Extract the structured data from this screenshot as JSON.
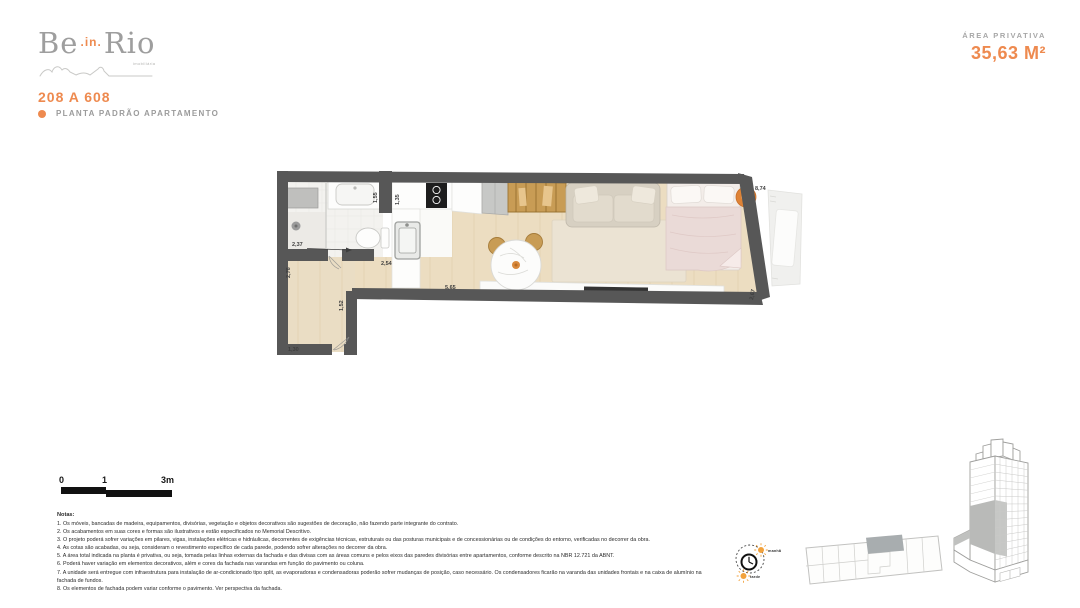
{
  "brand": {
    "be": "Be",
    "in": ".in.",
    "rio": "Rio",
    "tagline": "imobiliária"
  },
  "header": {
    "unit_range": "208 A 608",
    "plan_type": "PLANTA PADRÃO APARTAMENTO",
    "area_label": "ÁREA PRIVATIVA",
    "area_value": "35,63 M²"
  },
  "floorplan": {
    "dims": {
      "bath_width": "2,37",
      "left_side": "2,76",
      "hall": "2,54",
      "top_a": "1,55",
      "top_b": "1,35",
      "living_length": "5,65",
      "entry_side": "1,52",
      "entry_width": "1,30",
      "total_length": "8,74",
      "right_side": "2,67"
    }
  },
  "scale_bar": {
    "zero": "0",
    "one": "1",
    "three": "3m"
  },
  "notes": {
    "heading": "Notas:",
    "items": [
      "1. Os móveis, bancadas de madeira, equipamentos, divisórias, vegetação e objetos decorativos são sugestões de decoração, não fazendo parte integrante do contrato.",
      "2. Os acabamentos em suas cores e formas são ilustrativos e estão especificados no Memorial Descritivo.",
      "3. O projeto poderá sofrer variações em pilares, vigas, instalações elétricas e hidráulicas, decorrentes de exigências técnicas, estruturais ou das posturas municipais e de concessionárias ou de condições do entorno, verificadas no decorrer da obra.",
      "4. As cotas são acabadas, ou seja, consideram o revestimento específico de cada parede, podendo sofrer alterações no decorrer da obra.",
      "5. A área total indicada na planta é privativa, ou seja, tomada pelas linhas externas da fachada e das divisas com as áreas comuns e pelos eixos das paredes divisórias entre apartamentos, conforme descrito na NBR 12.721 da ABNT.",
      "6. Poderá haver variação em elementos decorativos, além e cores da fachada nas varandas em função do pavimento ou coluna.",
      "7. A unidade será entregue com infraestrutura para instalação de ar-condicionado tipo split, as evaporadoras e condensadoras poderão sofrer mudanças de posição, caso necessário. Os condensadores ficarão na varanda das unidades frontais e na caixa de alumínio na fachada de fundos.",
      "8. Os elementos de fachada podem variar conforme o pavimento. Ver perspectiva da fachada."
    ]
  },
  "sun_diagram": {
    "morning": "manhã",
    "afternoon": "tarde"
  },
  "colors": {
    "accent": "#EE8A4F",
    "muted_gray": "#9B9B9B",
    "wall": "#575757",
    "wood_floor": "#ECDDC1",
    "keyplan_highlight": "#A8ADAF",
    "sun": "#F2A23C"
  }
}
